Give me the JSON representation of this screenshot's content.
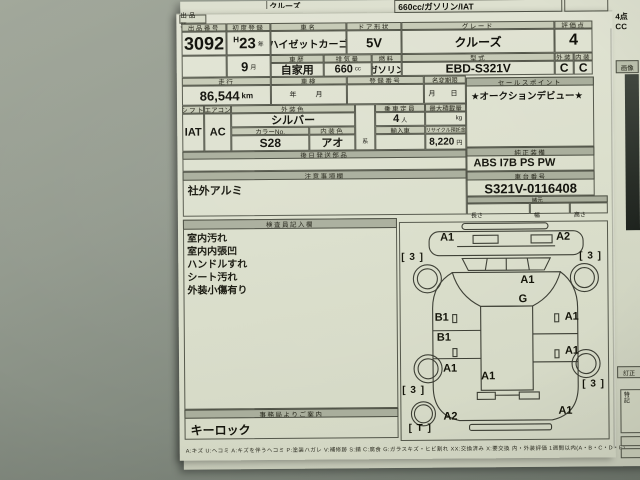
{
  "scene": {
    "top_sheet": {
      "grade_partial": "クルーズ",
      "spec_box": "660cc/ガソリン/IAT",
      "score_note": "4点 CC",
      "image_panel_label": "画像",
      "correction_label": "訂正",
      "side_note_label": "特記"
    },
    "form": {
      "sheet_label": "出品票",
      "lot": {
        "label": "出品番号",
        "value": "3092"
      },
      "first_reg": {
        "label": "初度登録",
        "era": "H",
        "year": "23",
        "year_unit": "年",
        "month": "9",
        "month_unit": "月"
      },
      "car_name": {
        "label": "車名",
        "value": "ハイゼットカーゴ"
      },
      "door": {
        "label": "ドア形状",
        "value": "5V"
      },
      "grade": {
        "label": "グレード",
        "value": "クルーズ"
      },
      "score": {
        "label": "評価点",
        "value": "4"
      },
      "exterior": {
        "label": "外装",
        "value": "C"
      },
      "interior": {
        "label": "内装",
        "value": "C"
      },
      "history": {
        "label": "車歴",
        "value": "自家用"
      },
      "displacement": {
        "label": "排気量",
        "value": "660",
        "unit": "cc"
      },
      "fuel": {
        "label": "燃料",
        "value": "ガソリン"
      },
      "model_code": {
        "label": "型式",
        "value": "EBD-S321V"
      },
      "mileage": {
        "label": "走行",
        "value": "86,544",
        "unit": "km"
      },
      "shaken": {
        "label": "車検",
        "value": "年　月"
      },
      "reg_no": {
        "label": "登録番号",
        "value": ""
      },
      "name_change": {
        "label": "名変期限",
        "value": "月　日"
      },
      "sales_point": {
        "label": "セールスポイント",
        "value": "★オークションデビュー★"
      },
      "shift": {
        "label": "シフト",
        "value": "IAT"
      },
      "aircon": {
        "label": "エアコン",
        "value": "AC"
      },
      "ext_color": {
        "label": "外装色",
        "value": "シルバー"
      },
      "color_no": {
        "label": "カラーNo.",
        "value": "S28"
      },
      "int_color": {
        "label": "内装色",
        "value": "アオ",
        "suffix": "系"
      },
      "capacity": {
        "label": "乗車定員",
        "value": "4",
        "unit": "人"
      },
      "max_load": {
        "label": "最大積載量",
        "unit": "kg"
      },
      "import_car": {
        "label": "輸入車"
      },
      "recycle": {
        "label": "リサイクル預託金",
        "value": "8,220",
        "unit": "円"
      },
      "later_parts": {
        "label": "後日発送部品"
      },
      "equipment": {
        "label": "純正装備",
        "value": "ABS I7B PS PW"
      },
      "chassis": {
        "label": "車台番号",
        "value": "S321V-0116408"
      },
      "specs": {
        "label": "諸元",
        "length_label": "長さ",
        "width_label": "幅",
        "height_label": "高さ"
      },
      "notes": {
        "label": "注意事項欄",
        "value": "社外アルミ"
      },
      "inspector": {
        "label": "検査員記入欄",
        "items": [
          "室内汚れ",
          "室内内張凹",
          "ハンドルすれ",
          "シート汚れ",
          "外装小傷有り"
        ]
      },
      "office": {
        "label": "事務局よりご案内",
        "value": "キーロック"
      },
      "legend": "A:キズ U:ヘコミ A:キズを伴うヘコミ P:塗装ハガレ V:補修跡 S:錆 C:腐食 G:ガラスキズ・ヒビ割れ XX:交換済み X:要交換 内・外装評価 1週間以内(A・B・C・D・E)"
    },
    "diagram": {
      "marks": [
        {
          "code": "A1",
          "x": 40,
          "y": 10
        },
        {
          "code": "A2",
          "x": 156,
          "y": 10
        },
        {
          "code": "A1",
          "x": 120,
          "y": 53
        },
        {
          "code": "G",
          "x": 118,
          "y": 72
        },
        {
          "code": "B1",
          "x": 34,
          "y": 90
        },
        {
          "code": "A1",
          "x": 164,
          "y": 90
        },
        {
          "code": "B1",
          "x": 36,
          "y": 110
        },
        {
          "code": "A1",
          "x": 164,
          "y": 124
        },
        {
          "code": "A1",
          "x": 42,
          "y": 141
        },
        {
          "code": "A1",
          "x": 80,
          "y": 149
        },
        {
          "code": "A2",
          "x": 42,
          "y": 189
        },
        {
          "code": "A1",
          "x": 157,
          "y": 184
        }
      ],
      "tires": [
        {
          "code": "3",
          "x": 1,
          "y": 30
        },
        {
          "code": "3",
          "x": 179,
          "y": 30
        },
        {
          "code": "3",
          "x": 1,
          "y": 163
        },
        {
          "code": "3",
          "x": 181,
          "y": 158
        },
        {
          "code": "T",
          "x": 7,
          "y": 201
        }
      ]
    },
    "colors": {
      "paper": "#dbdfcc",
      "paper_behind": "#d2d6c3",
      "header_fill": "#c6cab6",
      "header_dark": "#a9ae9c",
      "ink": "#14140c",
      "desk": "#8a9187"
    }
  }
}
